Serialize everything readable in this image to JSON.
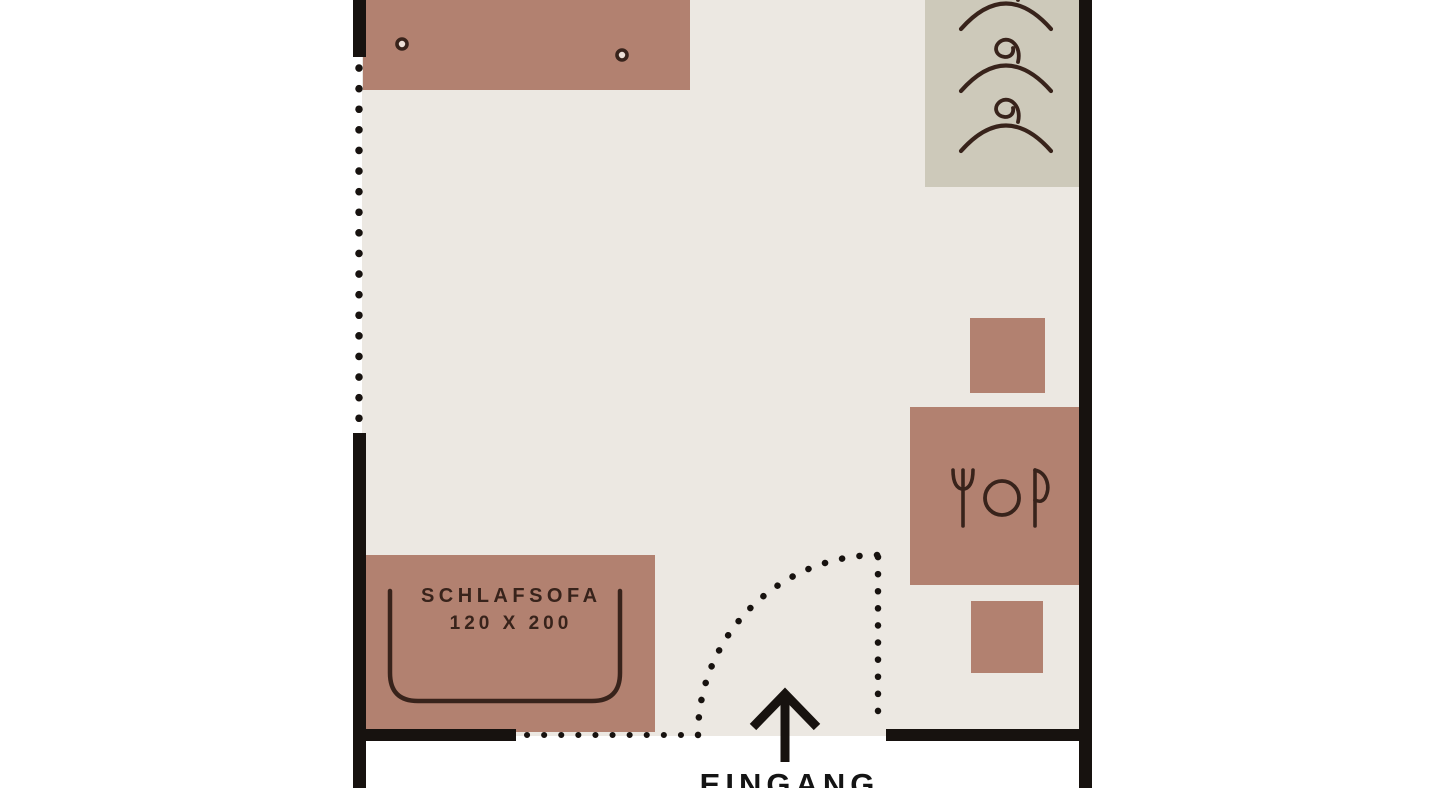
{
  "plan": {
    "room_label": "studio-floor-plan",
    "labels": {
      "sofa_name": "SCHLAFSOFA",
      "sofa_size": "120 X 200",
      "entrance": "EINGANG"
    }
  },
  "colors": {
    "background": "#ffffff",
    "floor": "#ece8e2",
    "furniture": "#b28170",
    "wardrobe": "#cdc9ba",
    "wall": "#17120f",
    "ink": "#38231b",
    "knob_center": "#ecdfd7",
    "entrance_text": "#141414"
  },
  "icons": {
    "wardrobe_hangers": [
      "hanger-icon",
      "hanger-icon",
      "hanger-icon"
    ],
    "table_place_setting": [
      "fork-icon",
      "plate-icon",
      "knife-icon"
    ],
    "counter_knobs": [
      "knob-icon",
      "knob-icon"
    ],
    "entrance_arrow": "arrow-up-icon"
  }
}
